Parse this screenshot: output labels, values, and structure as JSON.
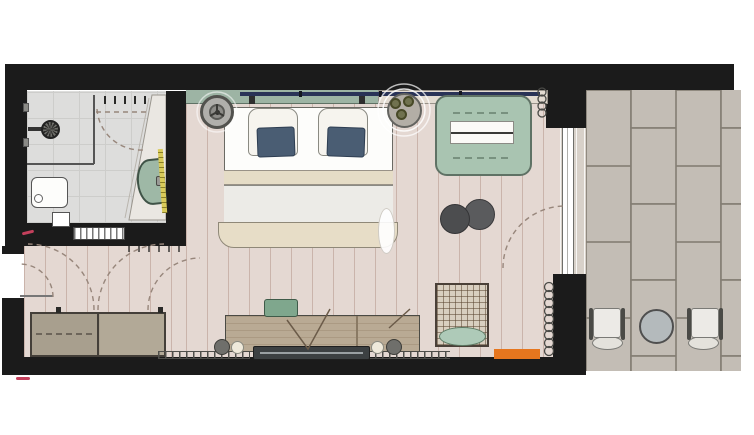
{
  "meta": {
    "title": "Hotel guest room floor plan",
    "type": "architectural-floor-plan",
    "visible_text": "none",
    "canvas": {
      "width_px": 754,
      "height_px": 435
    }
  },
  "palette": {
    "wall_black": "#1b1b1b",
    "bedroom_floor_pink_wood": "#e4d8d2",
    "bathroom_floor_gray": "#dddddc",
    "terrace_tile": "#c3bdb5",
    "terrace_grout": "#837d73",
    "headboard_green": "#9db4a4",
    "sofa_green": "#a9c4b1",
    "washbasin_green": "#9eb8a6",
    "armchair_cushion_green": "#aecab8",
    "pillow_cushion_blue": "#4a5d73",
    "window_navy": "#2a3357",
    "desk_wood": "#b9aa94",
    "desk_chair_green": "#7fa78d",
    "tv_dark_gray": "#3c4042",
    "doormat_orange": "#e6761e",
    "led_strip_yellow": "#d9cb5a",
    "door_swing_dash": "#97867b",
    "accent_red": "#c4405c"
  },
  "rooms": [
    {
      "id": "bathroom",
      "elements": [
        "walk-in-shower",
        "shower-head",
        "glass-partition",
        "shower-door-swing",
        "wall-hooks",
        "toilet",
        "side-shelf",
        "vanity-counter",
        "washbasin",
        "led-strip",
        "sliding-pocket-door"
      ]
    },
    {
      "id": "entry",
      "elements": [
        "entry-door",
        "entry-door-swing",
        "wardrobe-left-section",
        "wardrobe-right-section",
        "wardrobe-door-swings"
      ]
    },
    {
      "id": "bedroom",
      "elements": [
        "window-band",
        "headboard",
        "double-bed",
        "pillow-left",
        "pillow-right",
        "cushion-left",
        "cushion-right",
        "sheet-band",
        "duvet",
        "foot-blanket",
        "pendant-lamp",
        "plant-side-table",
        "window-sill",
        "sofa",
        "sofa-cushions",
        "coffee-table-large",
        "coffee-table-small",
        "sheer-curtain",
        "curtain-coil-top",
        "curtain-coil-bottom",
        "desk-sideboard",
        "desk-chair",
        "desk-lamp-left",
        "desk-lamp-right",
        "tv",
        "radiator-left",
        "radiator-right",
        "wicker-armchair",
        "armchair-cushion",
        "orange-doormat",
        "terrace-door-swing",
        "sliding-glass-door",
        "threshold"
      ]
    },
    {
      "id": "terrace",
      "elements": [
        "stone-tile-floor",
        "bistro-chair-left",
        "bistro-table",
        "bistro-chair-right"
      ]
    }
  ]
}
